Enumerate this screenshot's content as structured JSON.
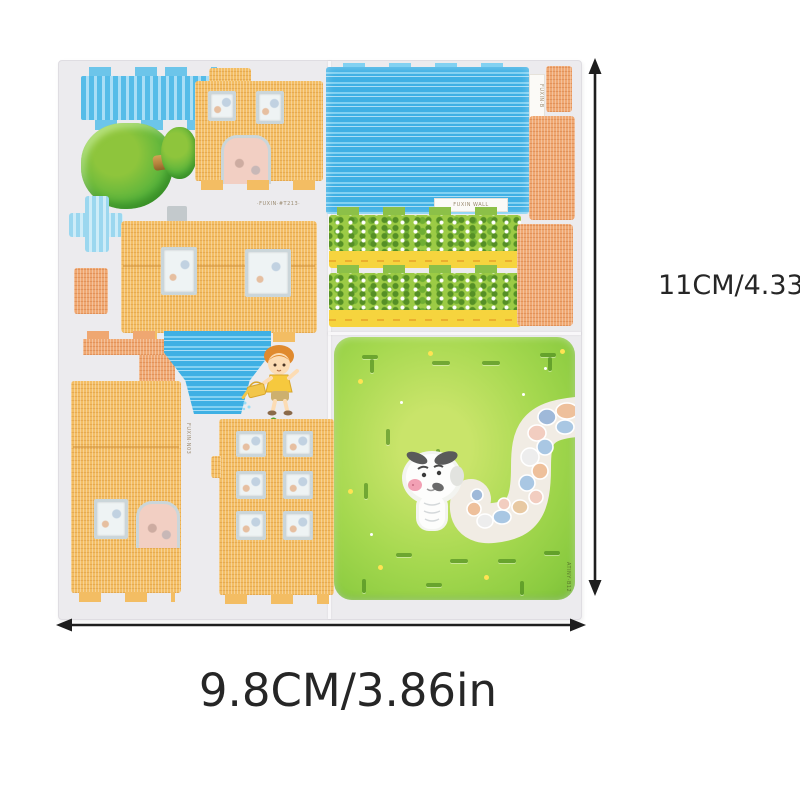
{
  "annotations": {
    "height_label": "11CM/4.33in",
    "width_label": "9.8CM/3.86in",
    "arrow_color": "#1e1e1e",
    "text_color": "#262626"
  },
  "sheet": {
    "description": "die-cut 3D foam puzzle sheet: house walls, roofs, hedges, tree, boy, cow and garden base board",
    "base_color": "#ecebee",
    "micro_labels": {
      "top_code": "·FUXIN·#T213·",
      "roof_tag": "FUXIN WALL",
      "right_edge_tag": "FUXIN·B",
      "left_panel_tag": "FUXIN·N03",
      "board_edge_tag": "ATINY·B12"
    },
    "colors": {
      "wall_orange": "#f3bd63",
      "piece_tan": "#efa771",
      "roof_blue": "#3fb0e4",
      "light_blue": "#9bd7ef",
      "hedge_green": "#9ccb45",
      "hedge_dark": "#558f26",
      "band_yellow": "#f6d43e",
      "board_green": "#9ed34c",
      "board_light": "#c9e46a",
      "tree_green": "#57b33c",
      "trunk_brown": "#b5823d",
      "path_stone_blue": "#a9c7e3",
      "path_stone_tan": "#eec09b",
      "path_stone_pink": "#f2cdc0",
      "window_frame": "#cbd6da",
      "cow_white": "#fdfdfc",
      "cow_patch": "#5a5a5a",
      "cow_nose": "#f2a0b4"
    }
  }
}
